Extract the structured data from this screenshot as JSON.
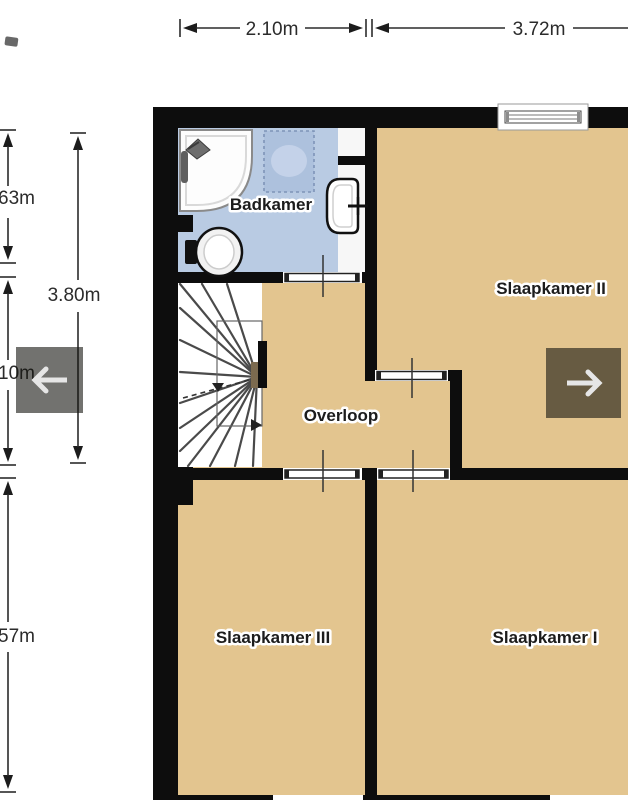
{
  "rooms": {
    "bathroom": "Badkamer",
    "bedroom2": "Slaapkamer II",
    "landing": "Overloop",
    "bedroom3": "Slaapkamer III",
    "bedroom1": "Slaapkamer I"
  },
  "dimensions": {
    "top_left_width": "2.10m",
    "top_right_width": "3.72m",
    "left_upper_partial": "63m",
    "left_total_height": "3.80m",
    "left_middle_partial": "10m",
    "left_lower_partial": "57m"
  },
  "nav": {
    "left_icon": "left-arrow-icon",
    "right_icon": "right-arrow-icon"
  },
  "colors": {
    "floor": "#e3c58f",
    "bathroom_floor": "#b9cbe3",
    "shower_area": "#adc1dd",
    "wall": "#0d0d0d",
    "nav_overlay": "rgba(20,20,15,0.6)",
    "arrow": "#e6e6e6"
  }
}
